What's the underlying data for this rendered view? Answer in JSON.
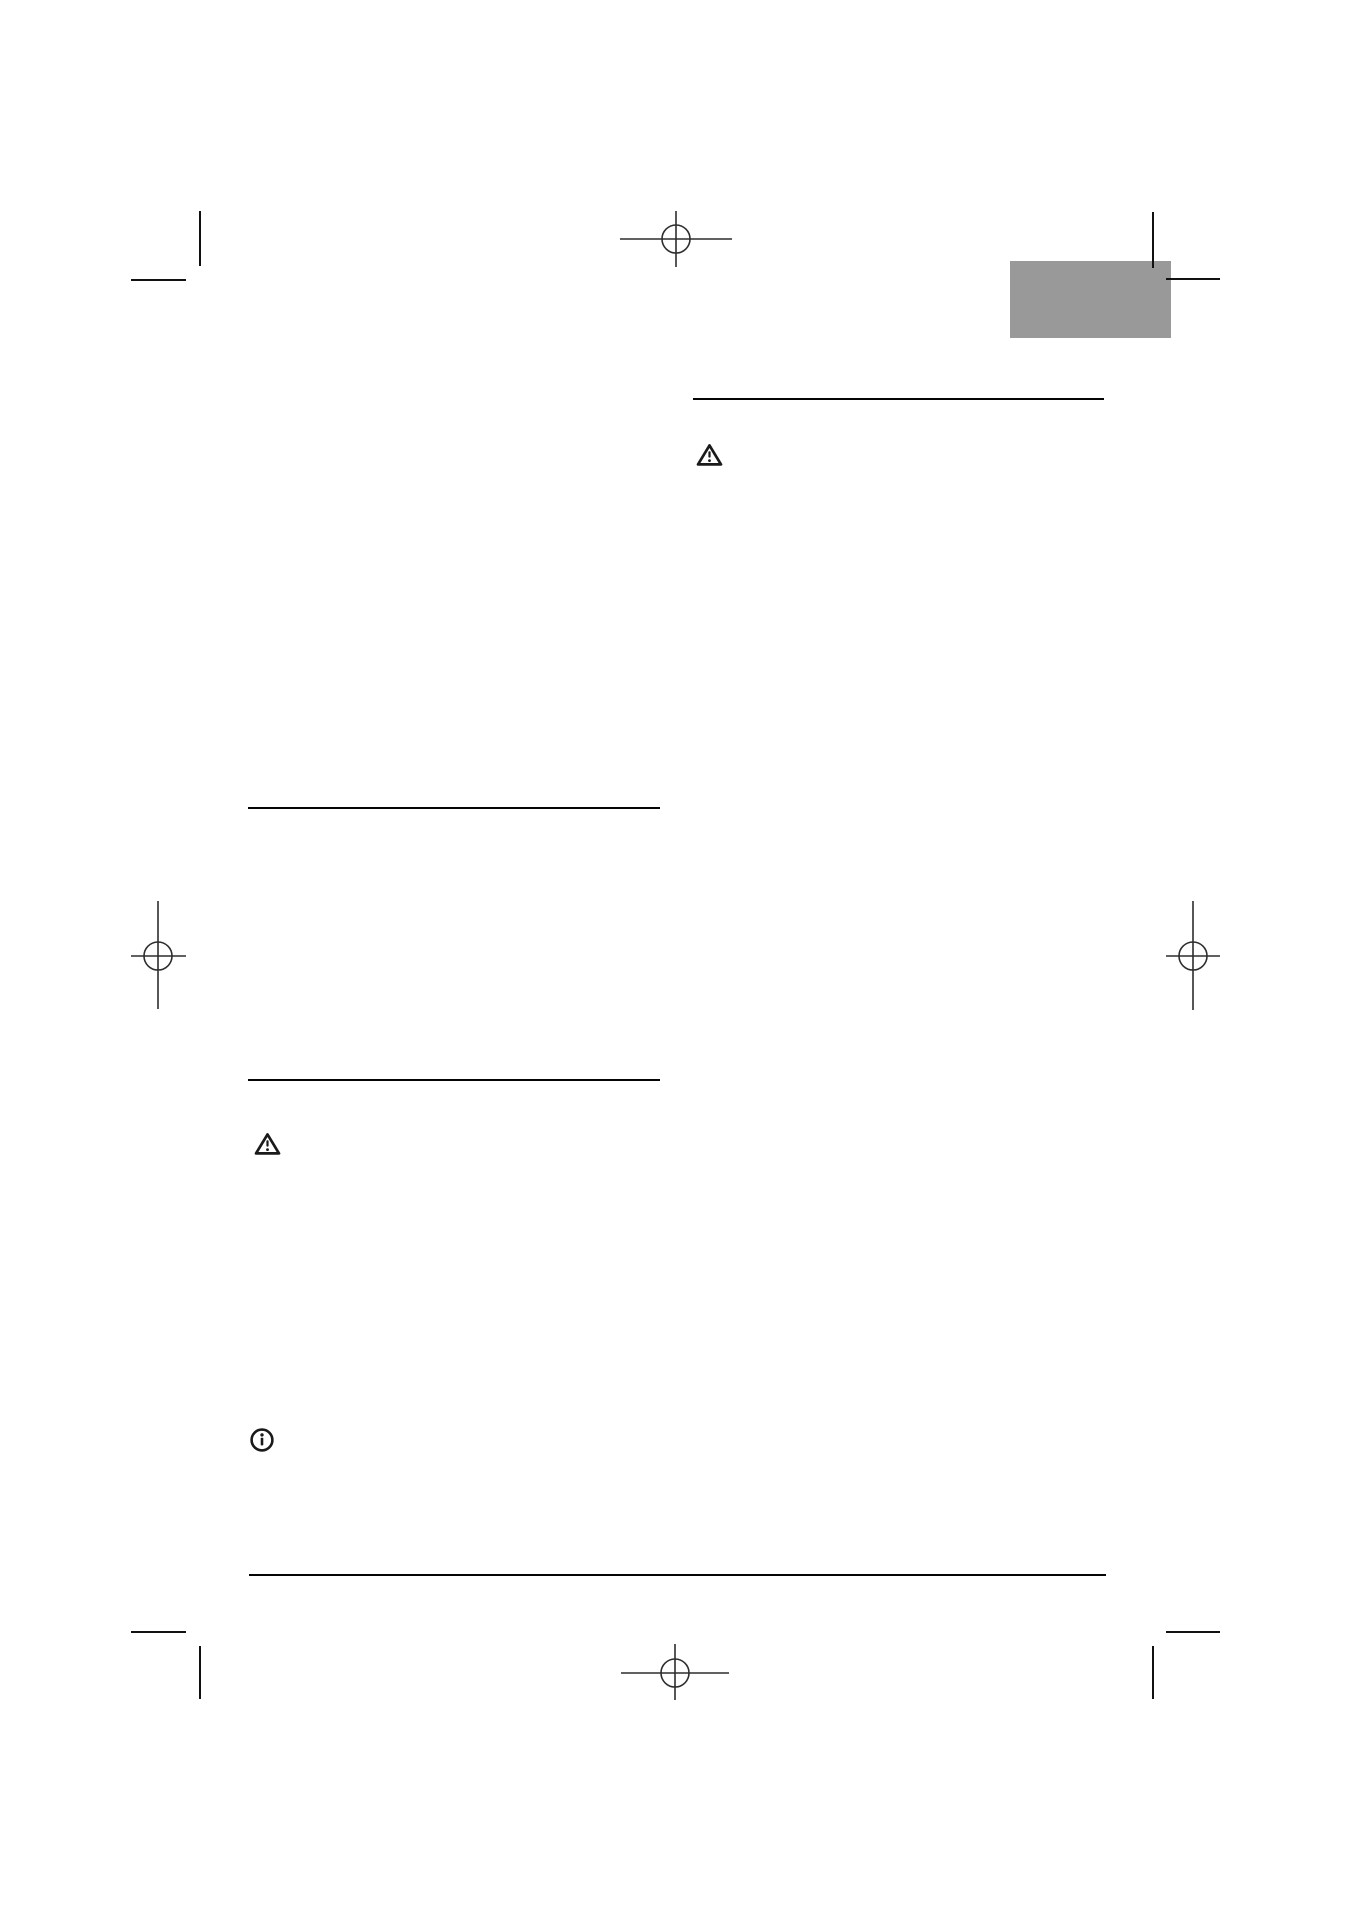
{
  "document": {
    "background_color": "#ffffff",
    "ink_color": "#1a1a1a",
    "rule_color": "#050505",
    "registration_mark_color": "#2d2d2d",
    "gray_block_color": "#999999",
    "visible_text": "",
    "icons": [
      {
        "name": "warning-triangle-icon",
        "location": "right-column-top"
      },
      {
        "name": "warning-triangle-icon",
        "location": "left-column-middle"
      },
      {
        "name": "info-circle-icon",
        "location": "left-column-lower"
      }
    ],
    "print_marks": {
      "registration_marks": [
        "top-center",
        "left-middle",
        "right-middle",
        "bottom-center"
      ],
      "corner_crop_marks": [
        "top-left",
        "top-right",
        "bottom-left",
        "bottom-right"
      ]
    },
    "rules": [
      "right-column-heading-rule",
      "left-column-heading-rule-1",
      "left-column-heading-rule-2",
      "footer-rule"
    ]
  }
}
